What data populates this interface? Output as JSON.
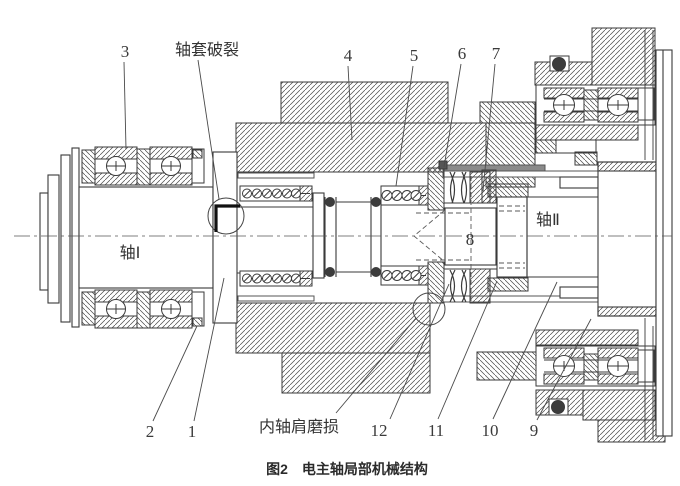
{
  "figure": {
    "caption": "图2　电主轴局部机械结构",
    "shaft1": "轴Ⅰ",
    "shaft2": "轴Ⅱ",
    "sleeve_crack": "轴套破裂",
    "shoulder_wear": "内轴肩磨损",
    "part_numbers": [
      "1",
      "2",
      "3",
      "4",
      "5",
      "6",
      "7",
      "8",
      "9",
      "10",
      "11",
      "12"
    ]
  },
  "colors": {
    "line": "#3a3a3a",
    "crack_mark": "#111111",
    "drawbar": "#8a8a8a",
    "background": "#ffffff"
  }
}
